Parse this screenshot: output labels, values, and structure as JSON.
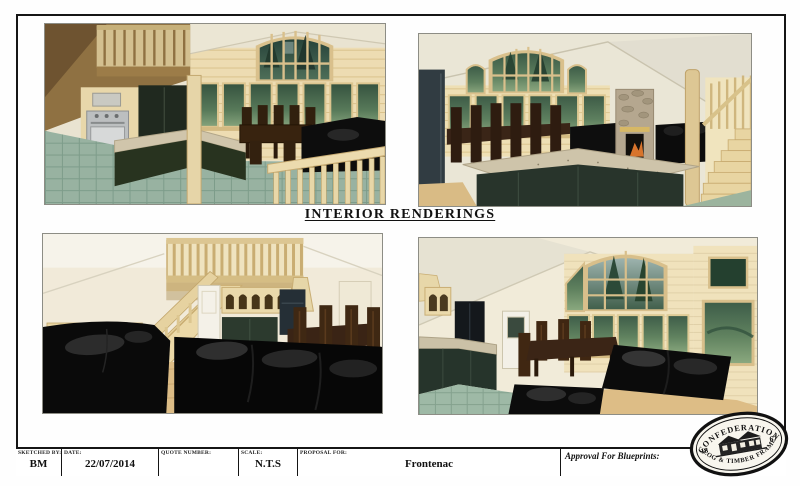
{
  "page": {
    "title": "INTERIOR RENDERINGS"
  },
  "renderings": [
    {
      "name": "kitchen-loft-dining-rendering"
    },
    {
      "name": "dining-island-fireplace-rendering"
    },
    {
      "name": "living-room-staircase-rendering"
    },
    {
      "name": "great-room-window-wall-rendering"
    }
  ],
  "title_block": {
    "fields": [
      {
        "label": "SKETCHED BY:",
        "value": "BM"
      },
      {
        "label": "DATE:",
        "value": "22/07/2014"
      },
      {
        "label": "QUOTE NUMBER:",
        "value": ""
      },
      {
        "label": "SCALE:",
        "value": "N.T.S"
      },
      {
        "label": "PROPOSAL FOR:",
        "value": "Frontenac"
      }
    ],
    "approval_label": "Approval For Blueprints:"
  },
  "logo": {
    "top_text": "CONFEDERATION",
    "bottom_text": "LOG & TIMBER FRAME",
    "left_year": "18",
    "right_year": "67"
  },
  "colors": {
    "border_black": "#151515",
    "pine_wood": "#ecdcb2",
    "dark_cabinet_green": "#27332a",
    "granite": "#cec4aa",
    "window_green": "#4e6e58",
    "tile_floor_teal": "#98b2a1",
    "wood_floor": "#dcbc86",
    "couch_black": "#0c0c0c",
    "dark_table_brown": "#3a2517",
    "wall_cream": "#eae5d4"
  }
}
